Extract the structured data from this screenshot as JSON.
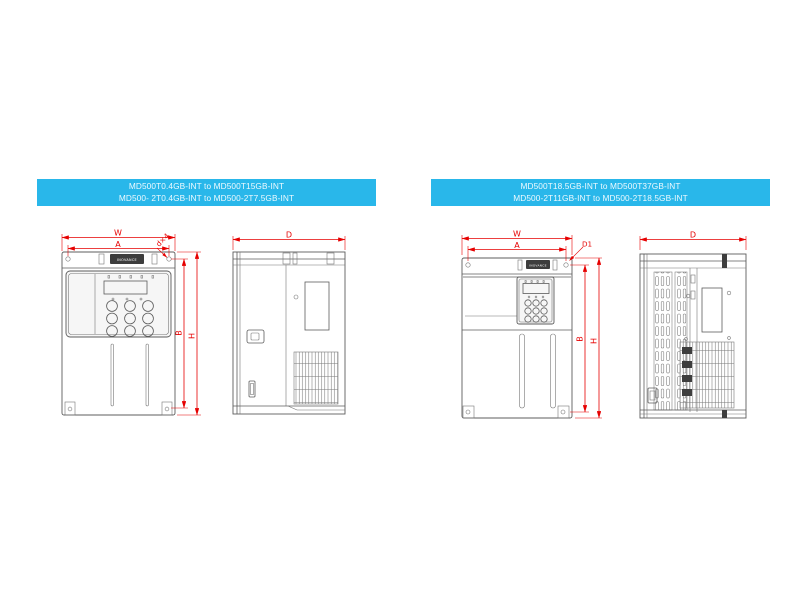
{
  "page": {
    "background": "#ffffff"
  },
  "panels": [
    {
      "banner": {
        "line1": "MD500T0.4GB-INT to MD500T15GB-INT",
        "line2": "MD500- 2T0.4GB-INT to MD500-2T7.5GB-INT"
      },
      "dims": {
        "width": "W",
        "mount_width": "A",
        "hole": "d×4",
        "mount_height": "B",
        "height": "H",
        "depth": "D"
      }
    },
    {
      "banner": {
        "line1": "MD500T18.5GB-INT to MD500T37GB-INT",
        "line2": "MD500-2T11GB-INT to MD500-2T18.5GB-INT"
      },
      "dims": {
        "width": "W",
        "mount_width": "A",
        "hole": "D1",
        "mount_height": "B",
        "height": "H",
        "depth": "D"
      }
    }
  ],
  "brand_label": "INOVANCE",
  "colors": {
    "banner_bg": "#29b7ea",
    "dimension_red": "#e60000",
    "drawing_gray": "#5c5c5c"
  }
}
